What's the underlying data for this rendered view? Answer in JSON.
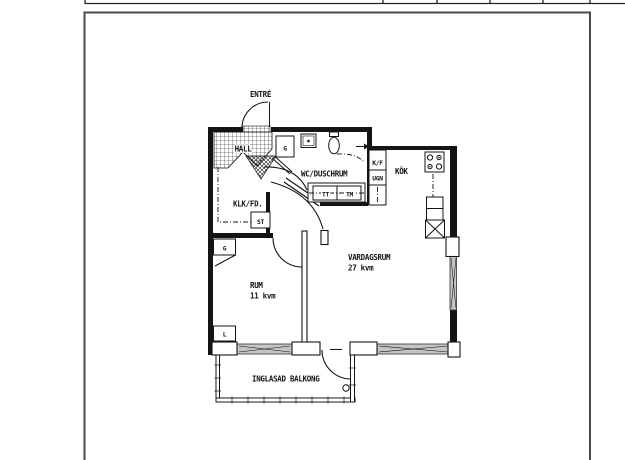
{
  "floor_plan": {
    "rooms": {
      "entre": "ENTRÉ",
      "hall": "HALL",
      "wc": "WC/DUSCHRUM",
      "kok": "KÖK",
      "klk": "KLK/FD.",
      "rum": "RUM",
      "rum_area": "11 kvm",
      "vardagsrum": "VARDAGSRUM",
      "vardagsrum_area": "27 kvm",
      "balkong": "INGLASAD BALKONG"
    },
    "fixtures": {
      "closet_hall": "G",
      "closet_rum": "G",
      "linen_closet": "L",
      "cleaning_closet": "ST",
      "fridge_freezer": "K/F",
      "oven": "UGN",
      "dryer": "TT",
      "washer": "TM"
    }
  },
  "colors": {
    "line": "#141414",
    "glazing": "#c4c4c4",
    "frame": "#4a4a4a",
    "bg": "#ffffff",
    "hatch": "#333333"
  }
}
